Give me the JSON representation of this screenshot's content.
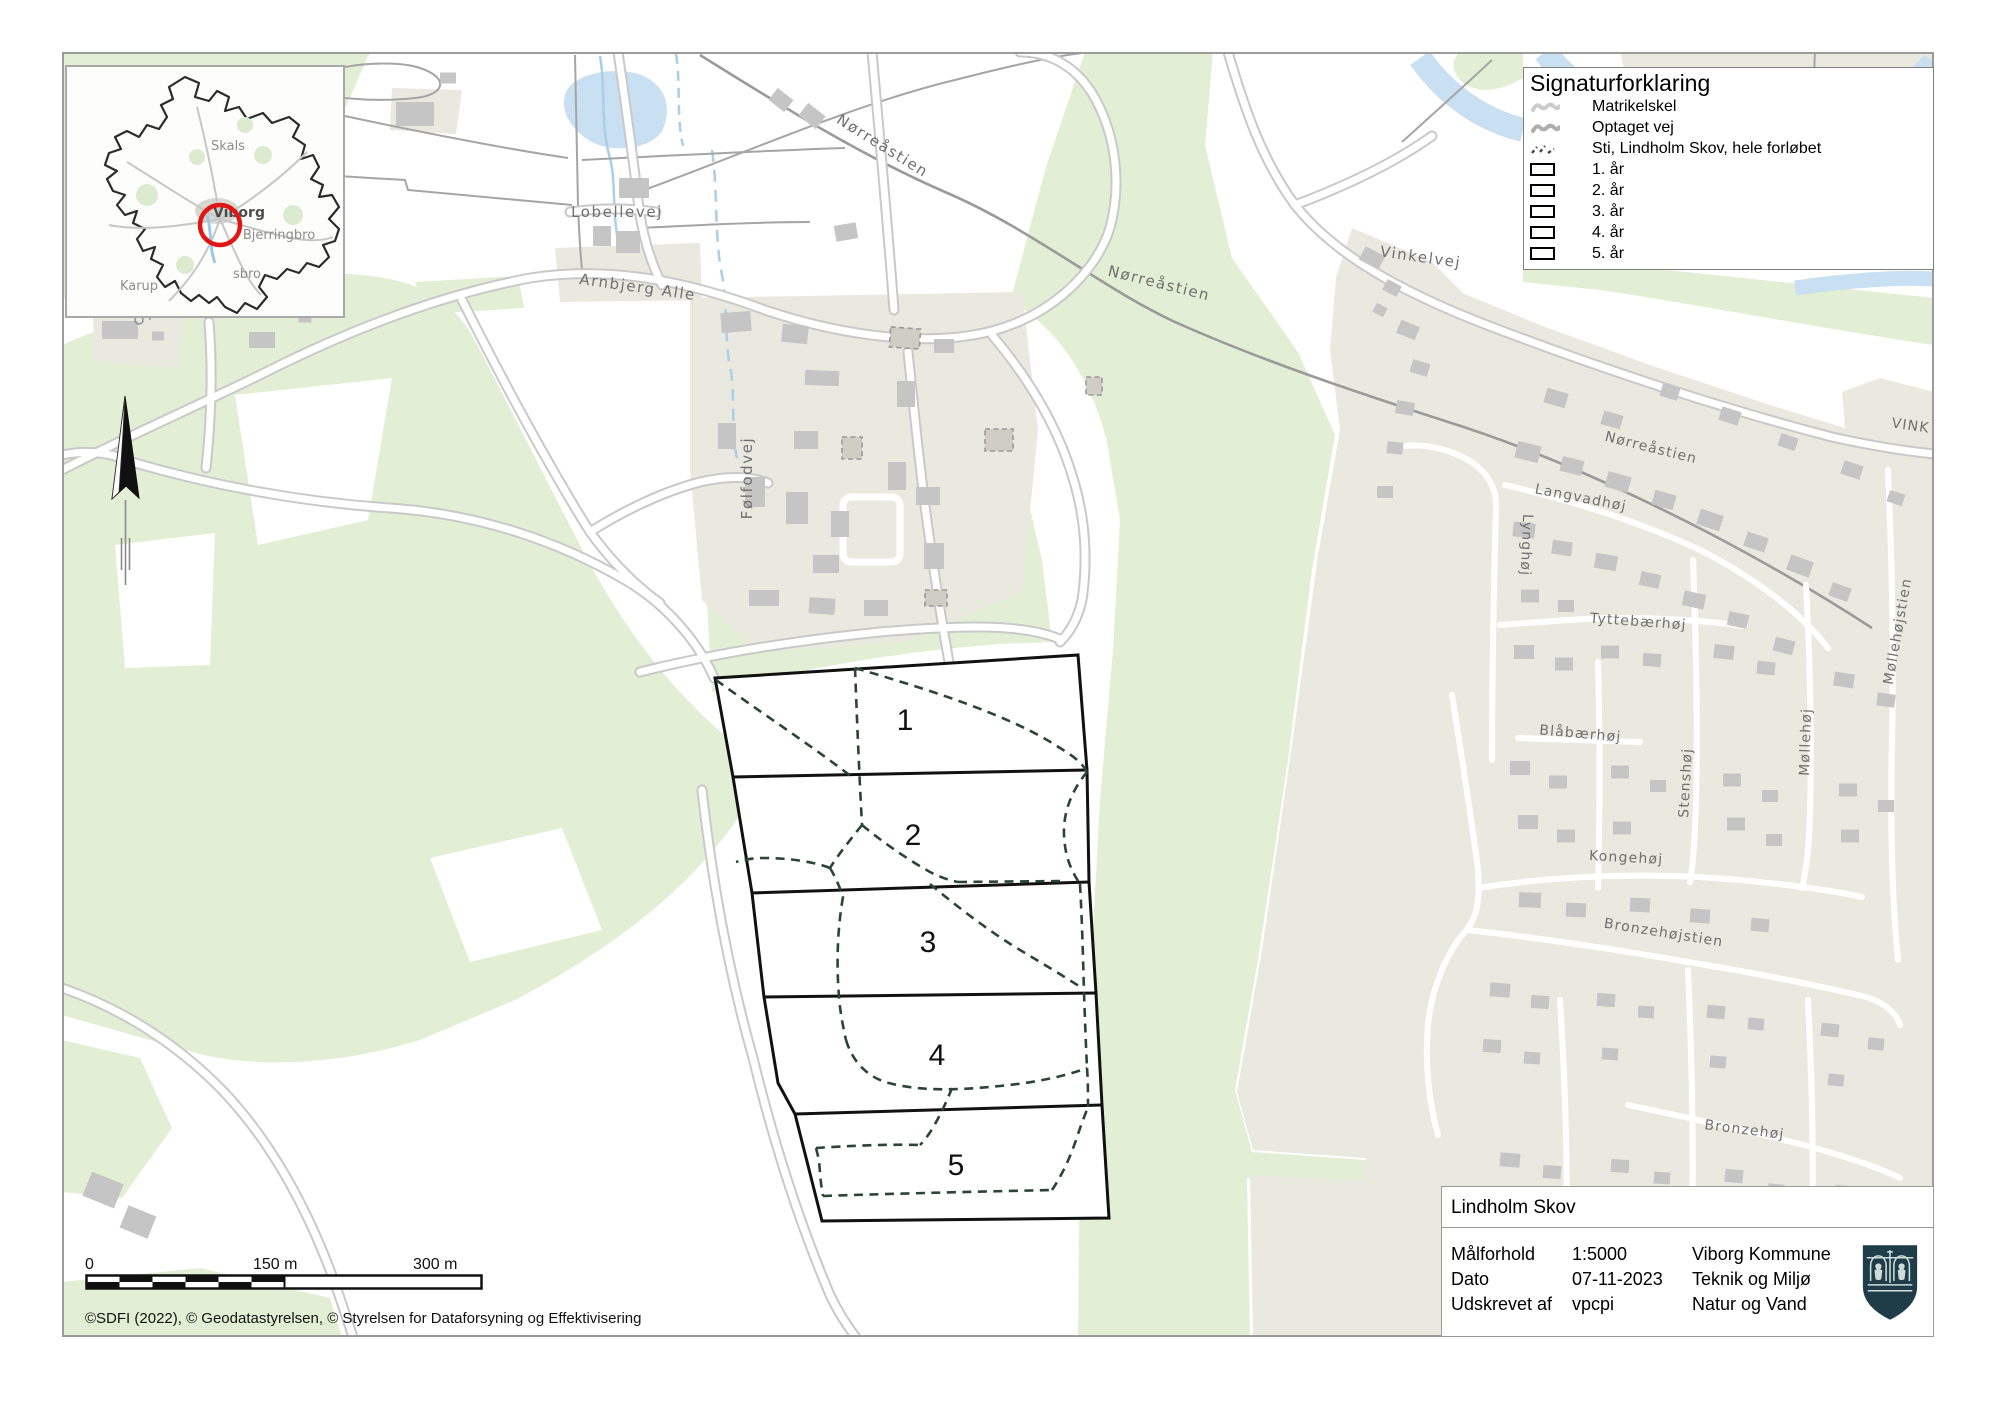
{
  "legend": {
    "title": "Signaturforklaring",
    "items": [
      {
        "label": "Matrikelskel",
        "icon": "wavy-light"
      },
      {
        "label": "Optaget vej",
        "icon": "wavy-dark"
      },
      {
        "label": "Sti, Lindholm Skov, hele forløbet",
        "icon": "dashed-path"
      },
      {
        "label": "1. år",
        "icon": "rect-outline"
      },
      {
        "label": "2. år",
        "icon": "rect-outline"
      },
      {
        "label": "3. år",
        "icon": "rect-outline"
      },
      {
        "label": "4. år",
        "icon": "rect-outline"
      },
      {
        "label": "5. år",
        "icon": "rect-outline"
      }
    ]
  },
  "info_panel": {
    "title": "Lindholm Skov",
    "rows": [
      {
        "label": "Målforhold",
        "value": "1:5000"
      },
      {
        "label": "Dato",
        "value": "07-11-2023"
      },
      {
        "label": "Udskrevet af",
        "value": "vpcpi"
      }
    ],
    "org": [
      "Viborg Kommune",
      "Teknik og Miljø",
      "Natur og Vand"
    ]
  },
  "scale_bar": {
    "start": "0",
    "mid": "150 m",
    "end": "300 m"
  },
  "copyright": "©SDFI (2022), © Geodatastyrelsen, © Styrelsen for Dataforsyning og Effektivisering",
  "parcels": [
    {
      "number": "1"
    },
    {
      "number": "2"
    },
    {
      "number": "3"
    },
    {
      "number": "4"
    },
    {
      "number": "5"
    }
  ],
  "street_labels": [
    {
      "text": "Nørreåstien"
    },
    {
      "text": "Lobellevej"
    },
    {
      "text": "Arnbjerg Alle"
    },
    {
      "text": "Følfodvej"
    },
    {
      "text": "Nørreåstien"
    },
    {
      "text": "Vinkelvej"
    },
    {
      "text": "Nørreåstien"
    },
    {
      "text": "Langvadhøj"
    },
    {
      "text": "Lynghøj"
    },
    {
      "text": "Tyttebærhøj"
    },
    {
      "text": "Møllehøjstien"
    },
    {
      "text": "Blåbærhøj"
    },
    {
      "text": "Stenshøj"
    },
    {
      "text": "Møllehøj"
    },
    {
      "text": "Kongehøj"
    },
    {
      "text": "Bronzehøjstien"
    },
    {
      "text": "Bronzehøj"
    },
    {
      "text": "VINK"
    }
  ],
  "inset": {
    "labels": [
      {
        "text": "Skals"
      },
      {
        "text": "Viborg"
      },
      {
        "text": "Bjerringbro"
      },
      {
        "text": "sbro"
      },
      {
        "text": "Karup"
      }
    ]
  },
  "colors": {
    "forest": "#e3efd4",
    "residential": "#e9e9e0",
    "building": "#c5c5c5",
    "water": "#c8e0f1",
    "road_casing": "#c9c9c9",
    "trail": "#2a4536",
    "parcel_outline": "#111111",
    "highlight_circle": "#e01616",
    "logo": "#1e3d49"
  }
}
